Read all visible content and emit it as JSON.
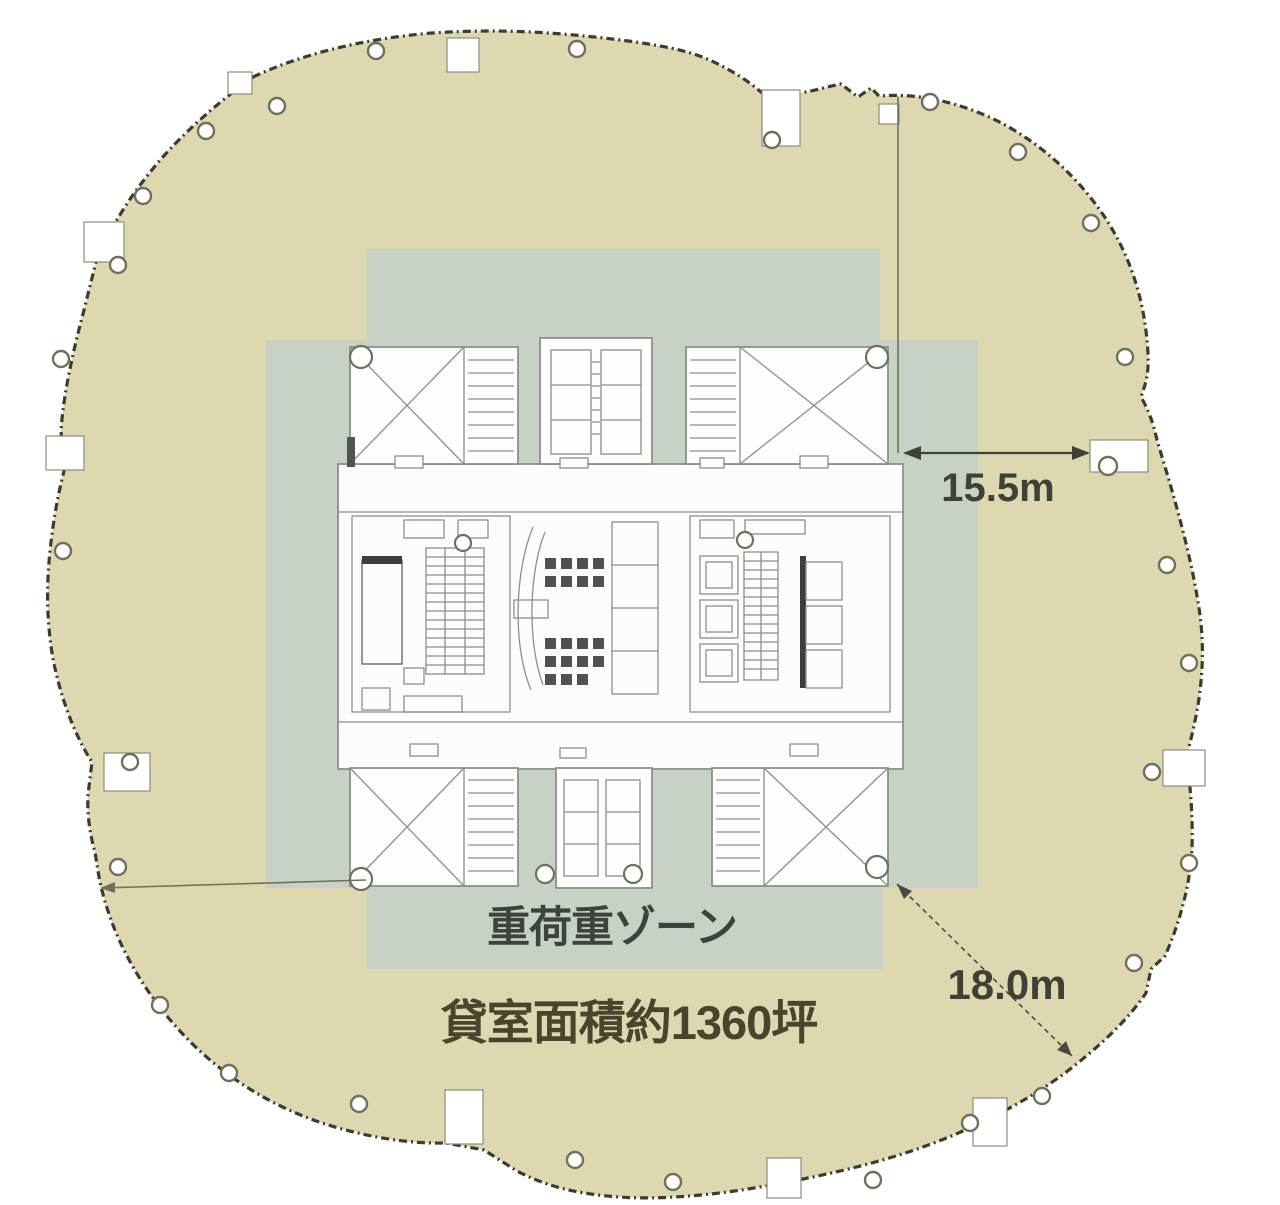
{
  "title": "高層ビル基準階 平面図 (typical floor plan)",
  "labels": {
    "zone": "重荷重ゾーン",
    "area": "貸室面積約1360坪",
    "dim_right": "15.5m",
    "dim_diag": "18.0m"
  },
  "colors": {
    "floor_plate": "#ded8b0",
    "heavy_load_zone": "#c7d1c6",
    "perimeter_line": "#3b3b31",
    "core_line": "#8a918a",
    "dimension": "#3e4138",
    "zone_text": "#3c423c",
    "area_text": "#4a442f"
  }
}
